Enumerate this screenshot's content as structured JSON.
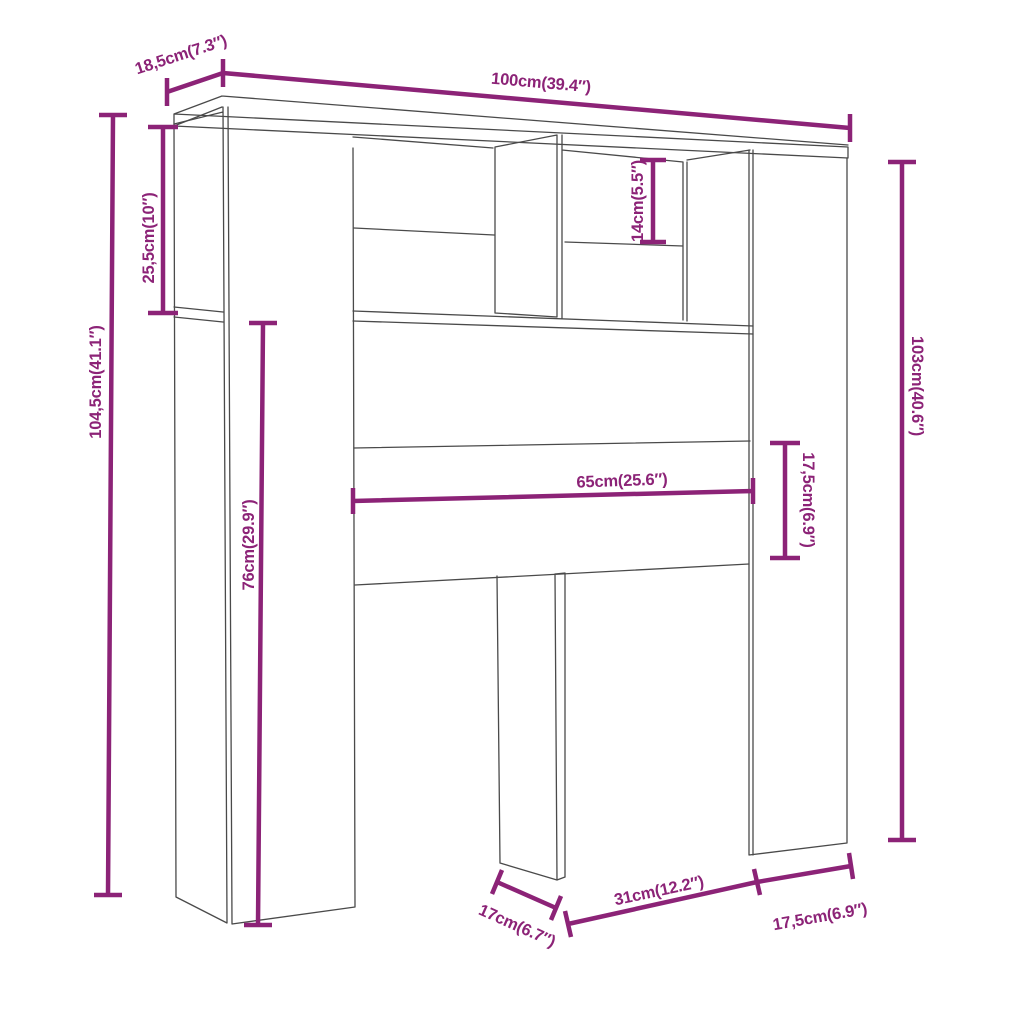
{
  "diagram": {
    "type": "furniture-dimension-diagram",
    "subject": "headboard storage cabinet line drawing with measurements",
    "colors": {
      "dimension": "#8C2377",
      "outline": "#4A4A4A",
      "background": "#FFFFFF"
    },
    "dimensions": [
      {
        "id": "top-depth",
        "label": "18,5cm(7.3″)",
        "cm": 18.5,
        "inches": 7.3
      },
      {
        "id": "total-width",
        "label": "100cm(39.4″)",
        "cm": 100,
        "inches": 39.4
      },
      {
        "id": "total-height",
        "label": "104,5cm(41.1″)",
        "cm": 104.5,
        "inches": 41.1
      },
      {
        "id": "top-compartment-height",
        "label": "25,5cm(10″)",
        "cm": 25.5,
        "inches": 10
      },
      {
        "id": "leg-section-height",
        "label": "76cm(29.9″)",
        "cm": 76,
        "inches": 29.9
      },
      {
        "id": "cubby-opening-height",
        "label": "14cm(5.5″)",
        "cm": 14,
        "inches": 5.5
      },
      {
        "id": "side-height",
        "label": "103cm(40.6″)",
        "cm": 103,
        "inches": 40.6
      },
      {
        "id": "rail-width",
        "label": "65cm(25.6″)",
        "cm": 65,
        "inches": 25.6
      },
      {
        "id": "rail-height",
        "label": "17,5cm(6.9″)",
        "cm": 17.5,
        "inches": 6.9
      },
      {
        "id": "leg-depth",
        "label": "17cm(6.7″)",
        "cm": 17,
        "inches": 6.7
      },
      {
        "id": "leg-gap-width",
        "label": "31cm(12.2″)",
        "cm": 31,
        "inches": 12.2
      },
      {
        "id": "right-gap-width",
        "label": "17,5cm(6.9″)",
        "cm": 17.5,
        "inches": 6.9
      }
    ]
  }
}
